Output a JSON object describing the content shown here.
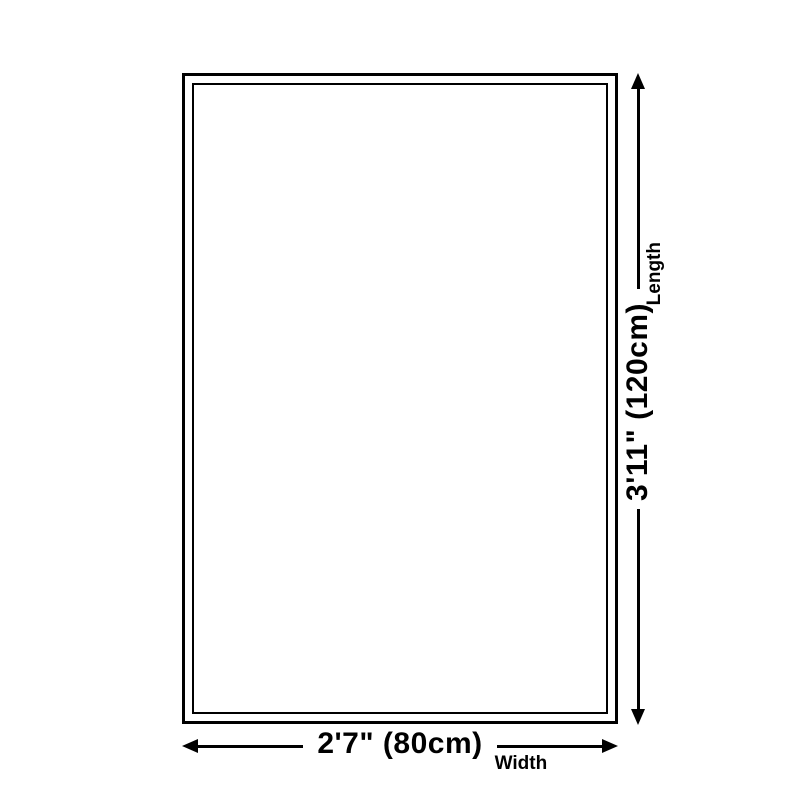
{
  "diagram": {
    "description": "rug-size-diagram",
    "colors": {
      "line": "#000000",
      "background": "#ffffff"
    },
    "dimensions": {
      "length": {
        "value": "3'11\" (120cm)",
        "label": "Length"
      },
      "width": {
        "value": "2'7\" (80cm)",
        "label": "Width"
      }
    }
  }
}
